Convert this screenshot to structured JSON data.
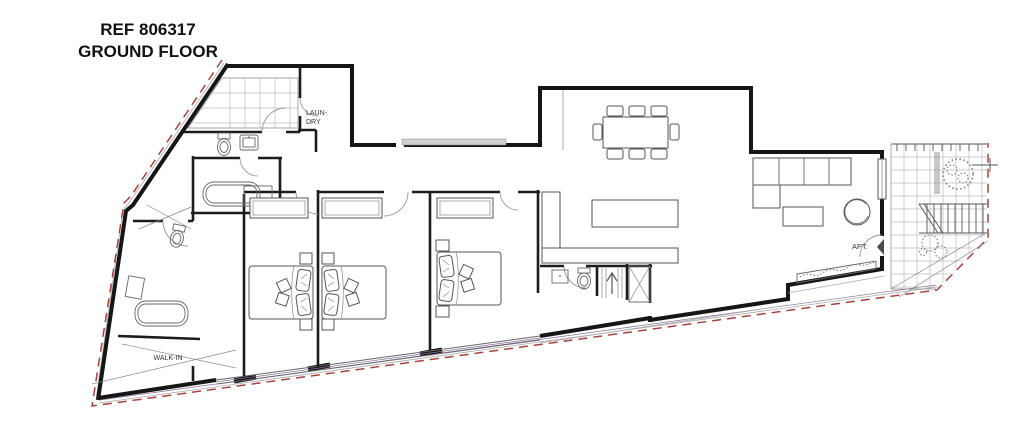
{
  "title": {
    "ref": "REF 806317",
    "floor": "GROUND FLOOR"
  },
  "labels": {
    "laundry_line1": "LAUN-",
    "laundry_line2": "DRY",
    "walk_in": "WALK-IN",
    "apartment": "APT."
  },
  "colors": {
    "wall": "#161616",
    "boundary_red": "#a8433c",
    "furniture_stroke": "#555555",
    "tile_grid": "#bcbcbc",
    "glazing_accent": "#8a6b9a",
    "vegetation": "#7b8d6f",
    "background": "#ffffff"
  }
}
